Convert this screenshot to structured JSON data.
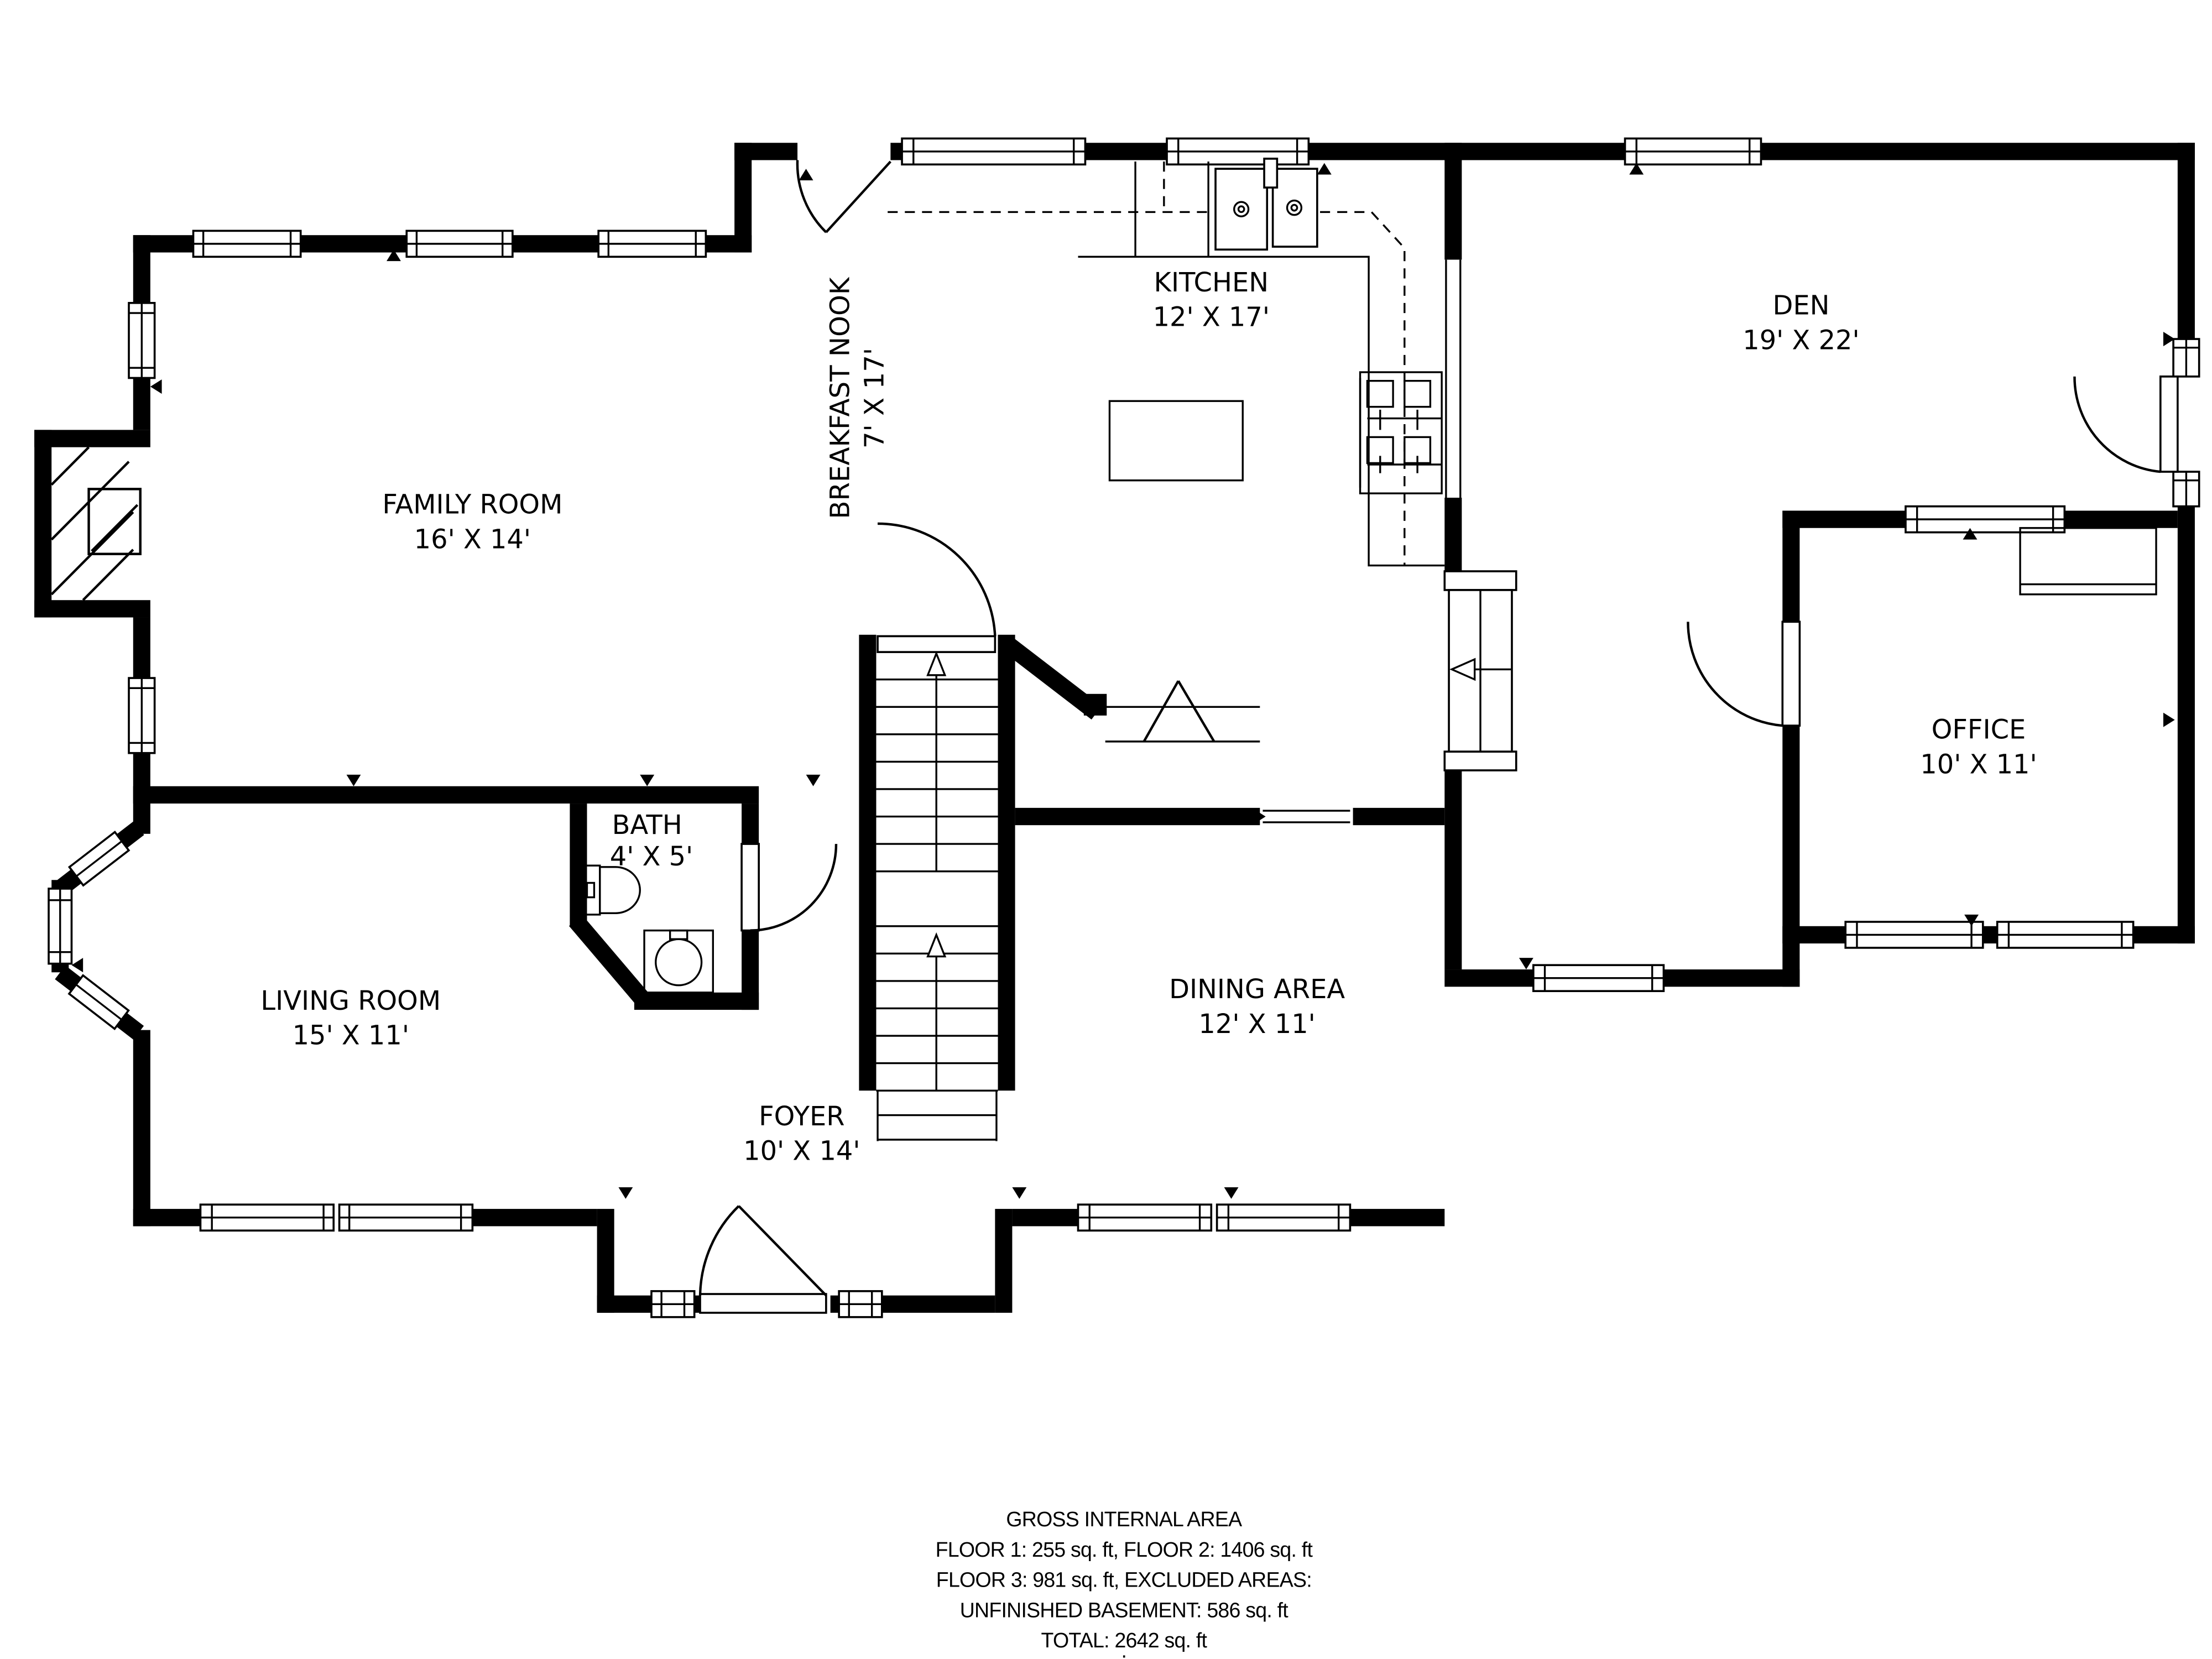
{
  "rooms": [
    {
      "id": "family_room",
      "name": "FAMILY ROOM",
      "dims": "16' X 14'"
    },
    {
      "id": "breakfast_nook",
      "name": "BREAKFAST NOOK",
      "dims": "7' X 17'"
    },
    {
      "id": "kitchen",
      "name": "KITCHEN",
      "dims": "12' X 17'"
    },
    {
      "id": "den",
      "name": "DEN",
      "dims": "19' X 22'"
    },
    {
      "id": "office",
      "name": "OFFICE",
      "dims": "10' X 11'"
    },
    {
      "id": "bath",
      "name": "BATH",
      "dims": "4' X 5'"
    },
    {
      "id": "living_room",
      "name": "LIVING ROOM",
      "dims": "15' X 11'"
    },
    {
      "id": "dining_area",
      "name": "DINING AREA",
      "dims": "12' X 11'"
    },
    {
      "id": "foyer",
      "name": "FOYER",
      "dims": "10' X 14'"
    }
  ],
  "area_summary": {
    "title": "GROSS INTERNAL AREA",
    "line1": "FLOOR 1: 255 sq. ft, FLOOR 2: 1406 sq. ft",
    "line2": "FLOOR 3: 981 sq. ft, EXCLUDED AREAS:",
    "line3": "UNFINISHED BASEMENT: 586 sq. ft",
    "line4": "TOTAL: 2642 sq. ft",
    "footnote": "."
  },
  "colors": {
    "walls": "#000000",
    "background": "#ffffff",
    "text": "#000000"
  }
}
